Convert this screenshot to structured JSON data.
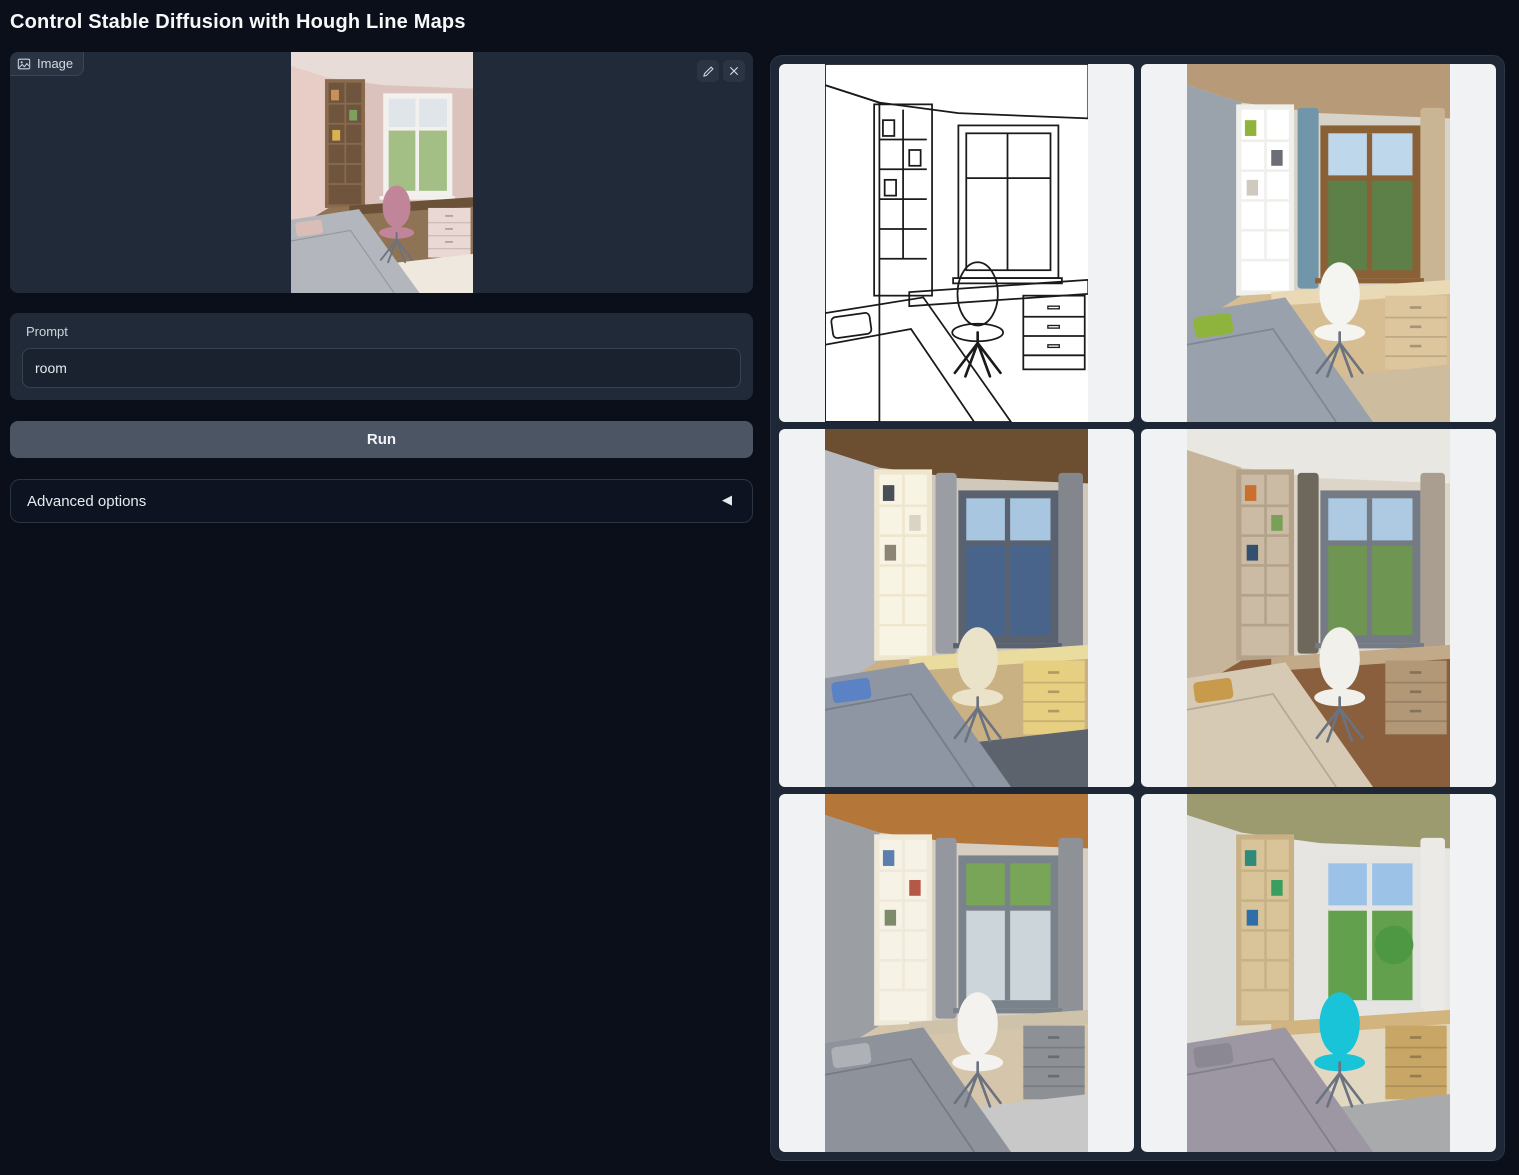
{
  "page": {
    "title": "Control Stable Diffusion with Hough Line Maps"
  },
  "theme": {
    "page_bg": "#0b0f19",
    "panel_bg": "#212a38",
    "panel_border": "#38424f",
    "button_bg": "#4b5563",
    "gallery_bg": "#1e2735",
    "cell_bg": "#f1f2f4",
    "accent_chair_cyan": "#19c4d9"
  },
  "input_image": {
    "label": "Image",
    "tools": [
      {
        "name": "edit",
        "icon": "pencil-icon"
      },
      {
        "name": "clear",
        "icon": "close-icon"
      }
    ],
    "content": {
      "name": "uploaded-room-photo",
      "style": "photo",
      "wallR": "#dcc2bc",
      "ceiling": "#e8dcd8",
      "wallL": "#e7cdc6",
      "shelf": "#8a6a4d",
      "shelfBack": "#6f553e",
      "books": [
        "#c9915a",
        "#7ea05e",
        "#d8b24e"
      ],
      "curtainL": null,
      "curtainR": null,
      "windowFrame": "#f3f1ee",
      "viewTop": "#dfe5e8",
      "viewBottom": "#a3bf85",
      "floor": "#8f7355",
      "desk": "#6b5138",
      "drawers": "#ead8d4",
      "rug": "#efe8df",
      "bed": "#b3b7bd",
      "pillow": "#d9bdb6",
      "chair": "#c08598"
    }
  },
  "prompt": {
    "label": "Prompt",
    "value": "room"
  },
  "run_button": {
    "label": "Run"
  },
  "advanced": {
    "label": "Advanced options",
    "state": "collapsed"
  },
  "gallery": {
    "items": [
      {
        "name": "hough-line-map",
        "style": "lines",
        "books": [
          "#1a1a1a",
          "#1a1a1a",
          "#1a1a1a"
        ]
      },
      {
        "name": "generated-room-1",
        "style": "photo",
        "wallR": "#d8d3c8",
        "ceiling": "#b79b79",
        "wallL": "#9aa3ab",
        "shelf": "#eff0ec",
        "shelfBack": "#ffffff",
        "books": [
          "#8fb43e",
          "#6b6f75",
          "#cfc9bf"
        ],
        "curtainL": "#7195a9",
        "curtainR": "#c9b594",
        "windowFrame": "#8a6137",
        "viewTop": "#bed7ea",
        "viewBottom": "#5c8048",
        "floor": "#d7bd92",
        "desk": "#ead9b5",
        "drawers": "#ddc69d",
        "rug": "#cdbd9e",
        "bed": "#99a1ad",
        "pillow": "#8fb43e",
        "chair": "#f4f4f1"
      },
      {
        "name": "generated-room-2",
        "style": "photo",
        "wallR": "#cfc8bb",
        "ceiling": "#6b4f30",
        "wallL": "#b7bac0",
        "shelf": "#eee6cf",
        "shelfBack": "#f8f4e4",
        "books": [
          "#4a4f57",
          "#d9d4c6",
          "#8c8474"
        ],
        "curtainL": "#9a9da4",
        "curtainR": "#83868d",
        "windowFrame": "#59626e",
        "viewTop": "#a9c6e0",
        "viewBottom": "#49648a",
        "floor": "#cab183",
        "desk": "#eadc9e",
        "drawers": "#e7cf82",
        "rug": "#5d636d",
        "bed": "#8d96a2",
        "pillow": "#5b82c4",
        "chair": "#eae3c9"
      },
      {
        "name": "generated-room-3",
        "style": "photo",
        "wallR": "#ddd5c8",
        "ceiling": "#e9e7e2",
        "wallL": "#c6b59b",
        "shelf": "#b4a28a",
        "shelfBack": "#cbbba4",
        "books": [
          "#c9702f",
          "#78a057",
          "#35506e"
        ],
        "curtainL": "#6e675c",
        "curtainR": "#a99e8f",
        "windowFrame": "#747b84",
        "viewTop": "#aecae2",
        "viewBottom": "#6e9552",
        "floor": "#8a5f3e",
        "desk": "#c2aa89",
        "drawers": "#b29877",
        "rug": null,
        "bed": "#d7cab4",
        "pillow": "#c89a4c",
        "chair": "#f2f0ea"
      },
      {
        "name": "generated-room-4",
        "style": "photo",
        "wallR": "#d6cec2",
        "ceiling": "#b5763a",
        "wallL": "#9b9ea3",
        "shelf": "#efe9d9",
        "shelfBack": "#f7f2e6",
        "books": [
          "#5b7fae",
          "#b65848",
          "#7d8b6a"
        ],
        "curtainL": "#94979d",
        "curtainR": "#8e9196",
        "windowFrame": "#7a828b",
        "viewTop": "#79a558",
        "viewBottom": "#ccd5da",
        "floor": "#d5c6ab",
        "desk": "#cfc2ab",
        "drawers": "#8d9196",
        "rug": "#c7c8c7",
        "bed": "#8e929b",
        "pillow": "#aeb1b6",
        "chair": "#f3f2ef"
      },
      {
        "name": "generated-room-5",
        "style": "photo",
        "wallR": "#e6e5e1",
        "ceiling": "#9c9a6f",
        "wallL": "#dbdcd7",
        "shelf": "#c9b186",
        "shelfBack": "#d9c49a",
        "books": [
          "#2e8b7a",
          "#3a9e5f",
          "#2f6ea8"
        ],
        "curtainL": null,
        "curtainR": "#eceae6",
        "windowFrame": "#e4e4e2",
        "viewTop": "#9cc2e8",
        "viewBottom": "#63a04d",
        "tree": "#4e9743",
        "floor": "#e2d8c2",
        "desk": "#d2b57e",
        "drawers": "#c8a766",
        "rug": "#a8aaac",
        "bed": "#9d97a4",
        "pillow": "#8b8894",
        "chair": "#19c4d9"
      }
    ]
  }
}
